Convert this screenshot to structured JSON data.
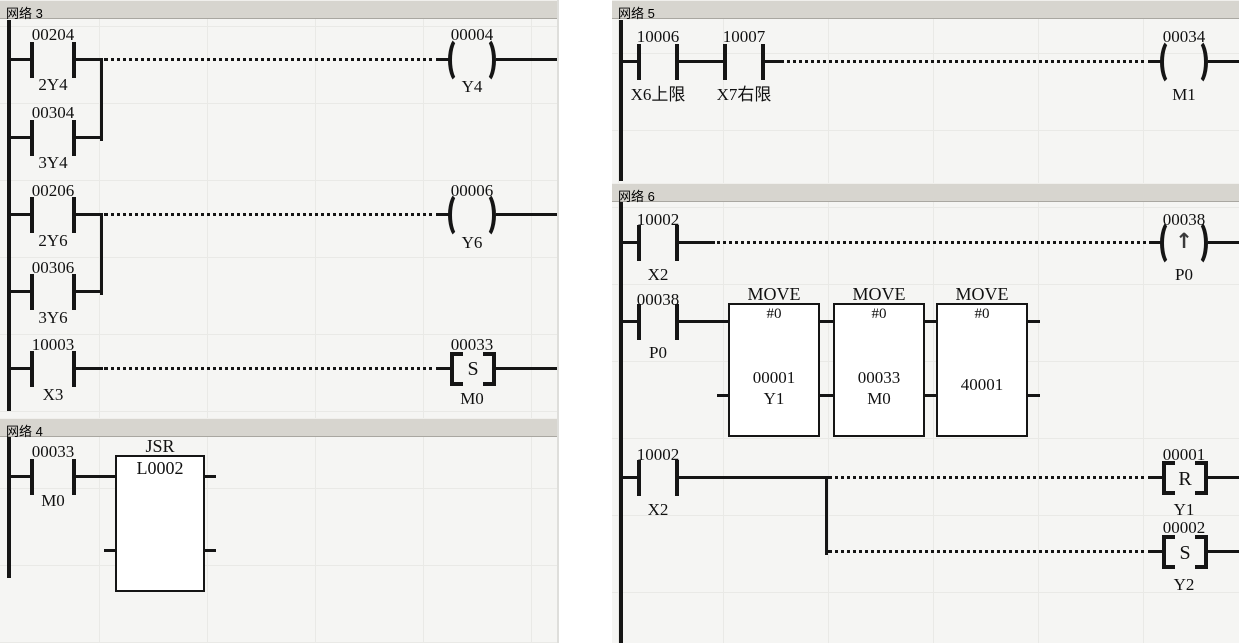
{
  "colors": {
    "line": "#151515",
    "header_bg": "#d7d5cf",
    "canvas_bg": "#f5f5f3",
    "block_bg": "#ffffff"
  },
  "left": {
    "net3": {
      "title": "网络 3",
      "r1": {
        "c1a": "00204",
        "c1s": "2Y4",
        "c2a": "00304",
        "c2s": "3Y4",
        "coila": "00004",
        "coils": "Y4"
      },
      "r2": {
        "c1a": "00206",
        "c1s": "2Y6",
        "c2a": "00306",
        "c2s": "3Y6",
        "coila": "00006",
        "coils": "Y6"
      },
      "r3": {
        "c1a": "10003",
        "c1s": "X3",
        "coila": "00033",
        "coils": "M0",
        "letter": "S"
      }
    },
    "net4": {
      "title": "网络 4",
      "c1a": "00033",
      "c1s": "M0",
      "block": {
        "title": "JSR",
        "operand": "L0002"
      }
    }
  },
  "right": {
    "net5": {
      "title": "网络 5",
      "c1a": "10006",
      "c1s": "X6上限",
      "c2a": "10007",
      "c2s": "X7右限",
      "coila": "00034",
      "coils": "M1"
    },
    "net6": {
      "title": "网络 6",
      "r1": {
        "c1a": "10002",
        "c1s": "X2",
        "coila": "00038",
        "coils": "P0",
        "symbol": "↑"
      },
      "r2": {
        "c1a": "00038",
        "c1s": "P0",
        "blocks": [
          {
            "title": "MOVE",
            "src": "#0",
            "dsta": "00001",
            "dsts": "Y1"
          },
          {
            "title": "MOVE",
            "src": "#0",
            "dsta": "00033",
            "dsts": "M0"
          },
          {
            "title": "MOVE",
            "src": "#0",
            "dsta": "40001"
          }
        ]
      },
      "r3": {
        "c1a": "10002",
        "c1s": "X2",
        "coil1a": "00001",
        "coil1s": "Y1",
        "letter1": "R",
        "coil2a": "00002",
        "coil2s": "Y2",
        "letter2": "S"
      }
    }
  }
}
